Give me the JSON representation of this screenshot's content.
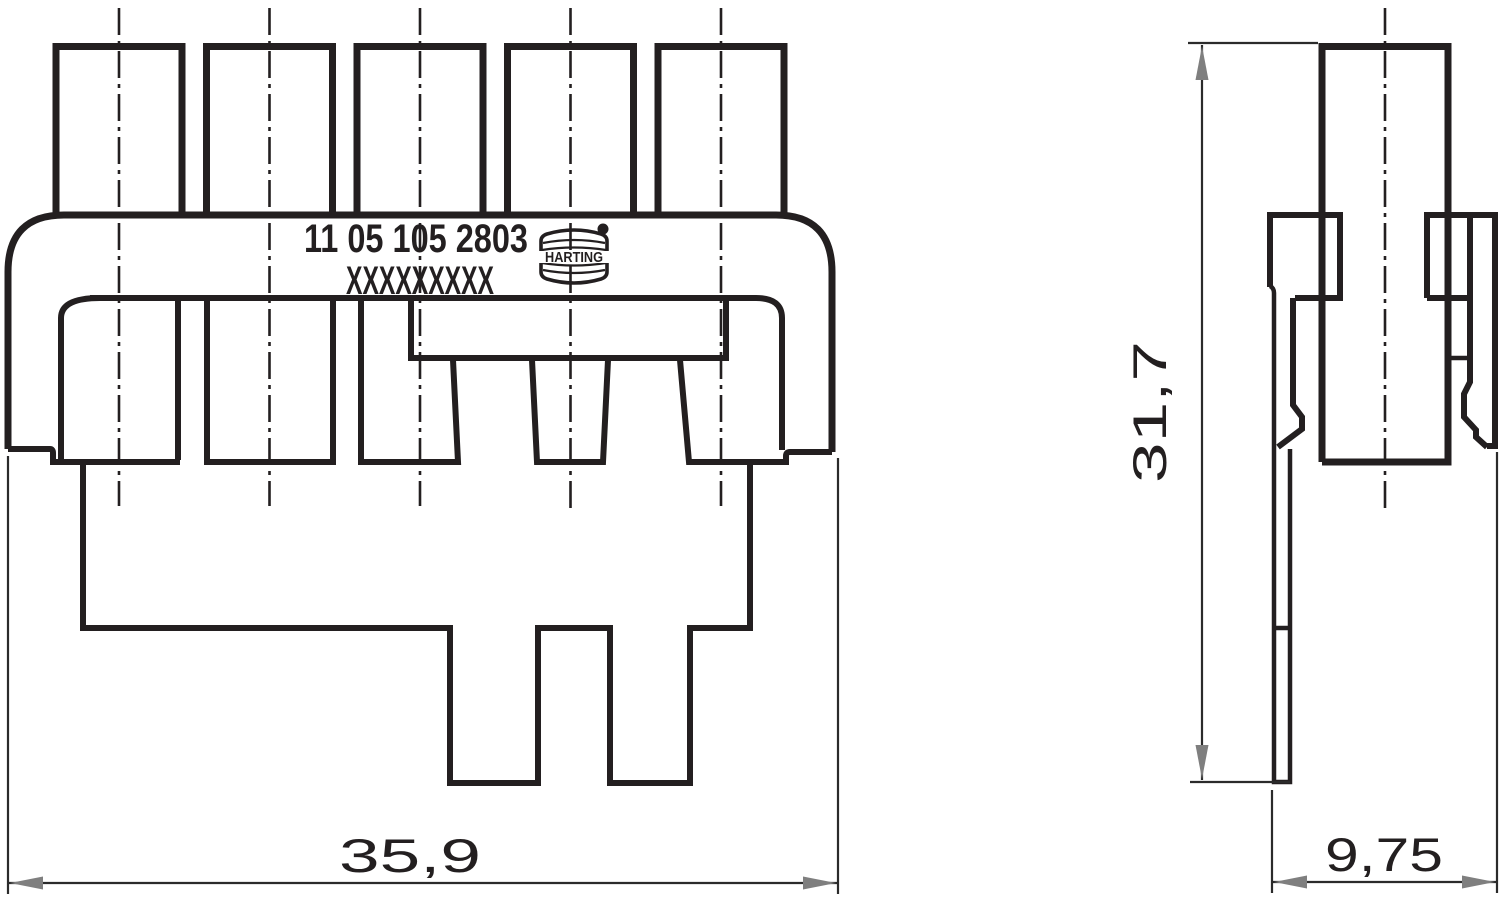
{
  "drawing": {
    "type": "connector-technical-drawing",
    "part_marking": {
      "line1": "11 05 105 2803",
      "line2": "XXXXXXXXX"
    },
    "logo": {
      "text": "HARTING",
      "registered_mark": "registered-dot"
    },
    "dimensions": {
      "front_overall_width_mm": "35,9",
      "side_overall_height_mm": "31,7",
      "side_overall_depth_mm": "9,75"
    },
    "front_view": {
      "pin_count": 5
    },
    "colors": {
      "line": "#231f20",
      "dimension_line": "#2b2b2b",
      "arrowhead": "#7f7f7f",
      "background": "#ffffff"
    }
  }
}
